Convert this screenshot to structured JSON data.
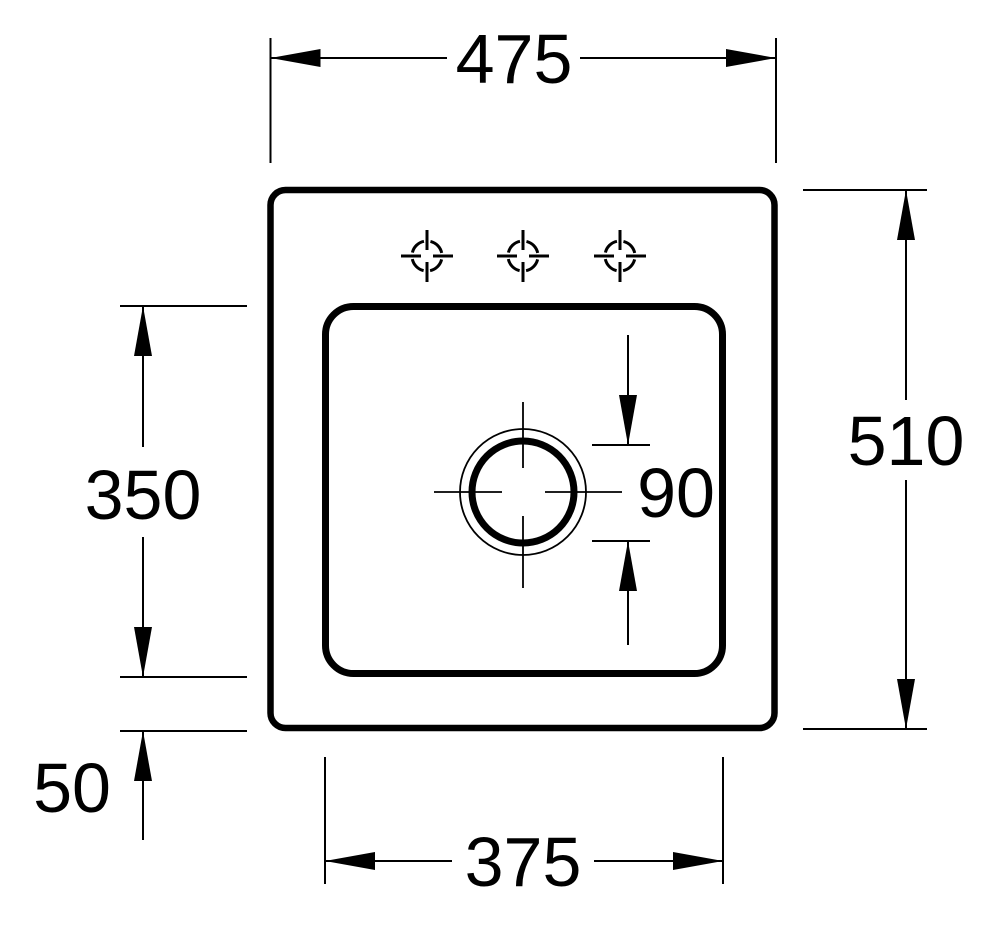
{
  "drawing": {
    "type": "technical-drawing-top-view",
    "subject": "built-in sink with single basin, drain hole and three faucet hole markers",
    "background_color": "#ffffff",
    "line_color": "#000000",
    "faucet_hole_count": 3,
    "icons": {
      "faucet_hole_marker": "crosshair-target-icon",
      "drain_marker": "double-circle-with-centerlines"
    },
    "dimensions": {
      "overall_width": "475",
      "overall_depth": "510",
      "basin_depth": "350",
      "basin_width": "375",
      "basin_bottom_offset": "50",
      "drain_diameter": "90"
    }
  }
}
